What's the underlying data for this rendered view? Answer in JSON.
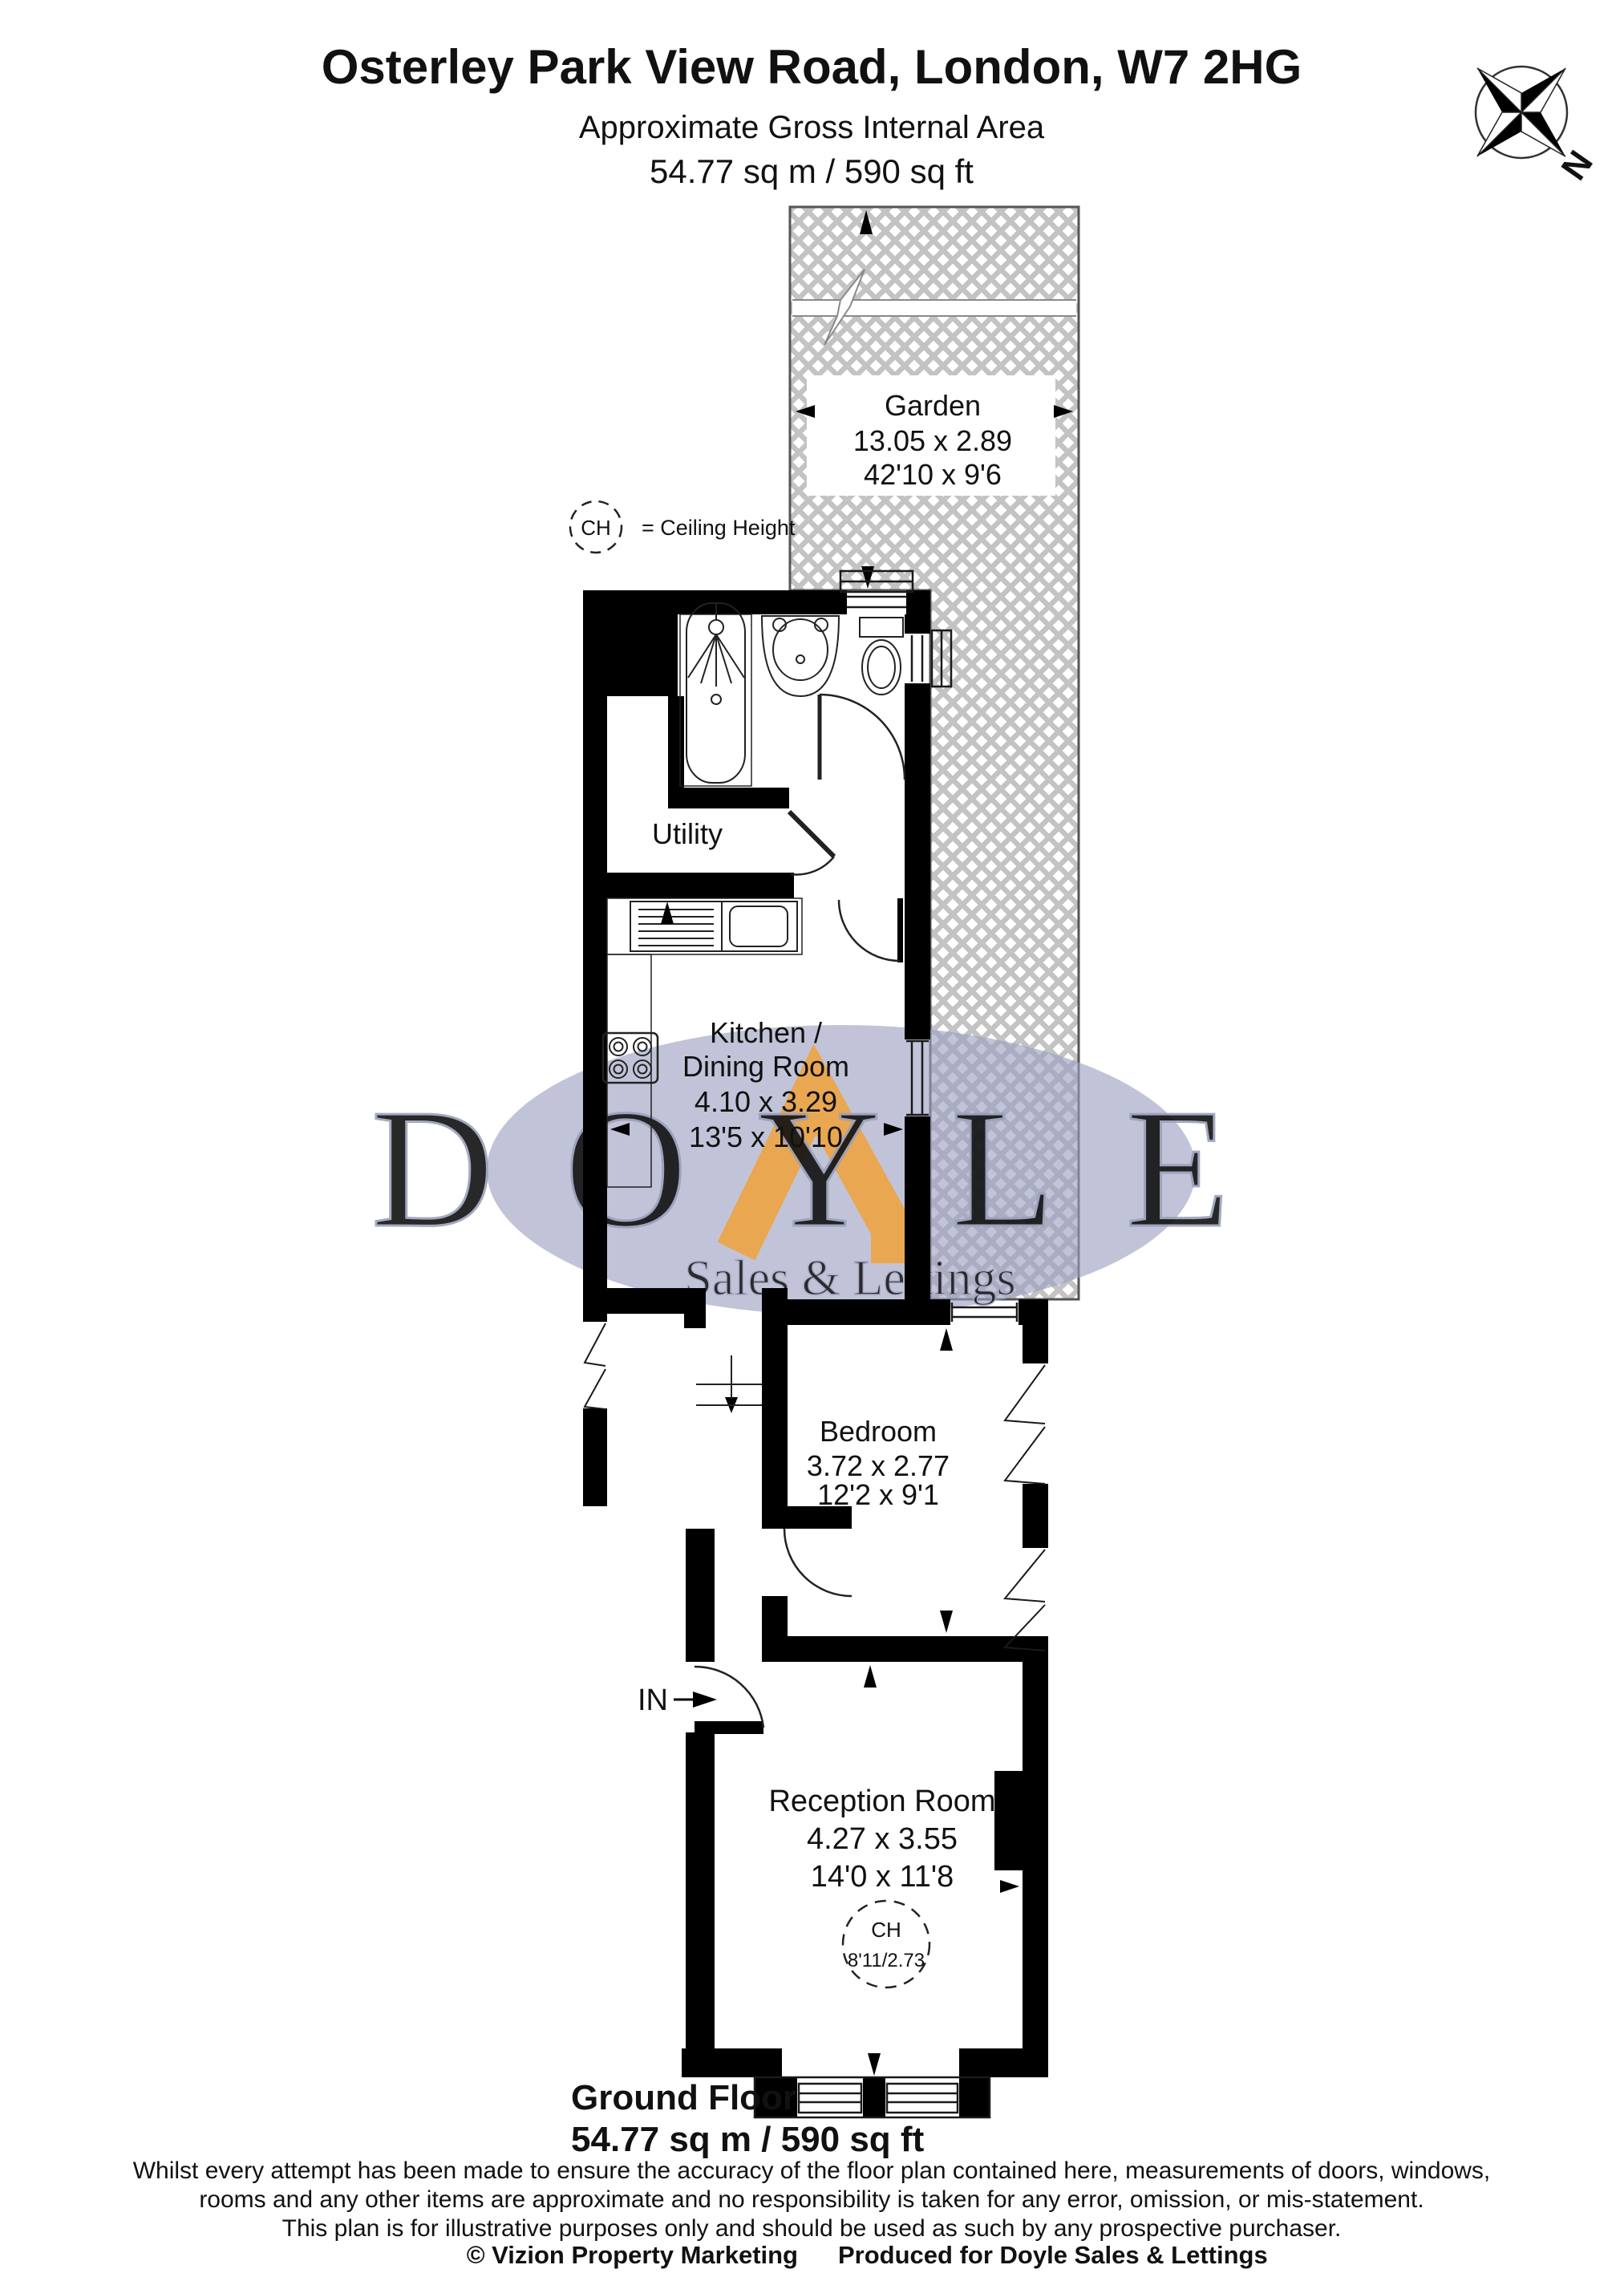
{
  "header": {
    "title": "Osterley Park View Road, London, W7 2HG",
    "subtitle": "Approximate Gross Internal Area",
    "area": "54.77 sq m / 590 sq ft"
  },
  "compass": {
    "north_label": "N"
  },
  "legend": {
    "symbol": "CH",
    "meaning": "=  Ceiling Height"
  },
  "garden": {
    "name": "Garden",
    "dims_m": "13.05 x 2.89",
    "dims_ft": "42'10 x 9'6"
  },
  "rooms": {
    "utility": {
      "name": "Utility"
    },
    "kitchen": {
      "name_line1": "Kitchen /",
      "name_line2": "Dining Room",
      "dims_m": "4.10 x 3.29",
      "dims_ft": "13'5 x 10'10"
    },
    "bedroom": {
      "name": "Bedroom",
      "dims_m": "3.72 x 2.77",
      "dims_ft": "12'2 x 9'1"
    },
    "reception": {
      "name": "Reception Room",
      "dims_m": "4.27 x 3.55",
      "dims_ft": "14'0 x 11'8",
      "ch_symbol": "CH",
      "ch_value": "8'11/2.73"
    }
  },
  "entrance": {
    "label": "IN"
  },
  "floor": {
    "name": "Ground Floor",
    "area": "54.77 sq m / 590 sq ft"
  },
  "disclaimer": {
    "line1": "Whilst every attempt has been made to ensure the accuracy of the floor plan contained here, measurements of doors, windows,",
    "line2": "rooms and any other items are approximate and no responsibility is taken for any error, omission, or mis-statement.",
    "line3": "This plan is for illustrative purposes only and should be used as such by any prospective purchaser."
  },
  "footer": {
    "credit": "© Vizion Property Marketing",
    "produced": "Produced for Doyle Sales & Lettings"
  },
  "watermark": {
    "name": "DOYLE",
    "tagline": "Sales & Lettings"
  },
  "colors": {
    "wall": "#000000",
    "hatch": "#c3c3c3",
    "watermark_blue": "#9ba0c0",
    "watermark_orange": "#f0a23a"
  }
}
